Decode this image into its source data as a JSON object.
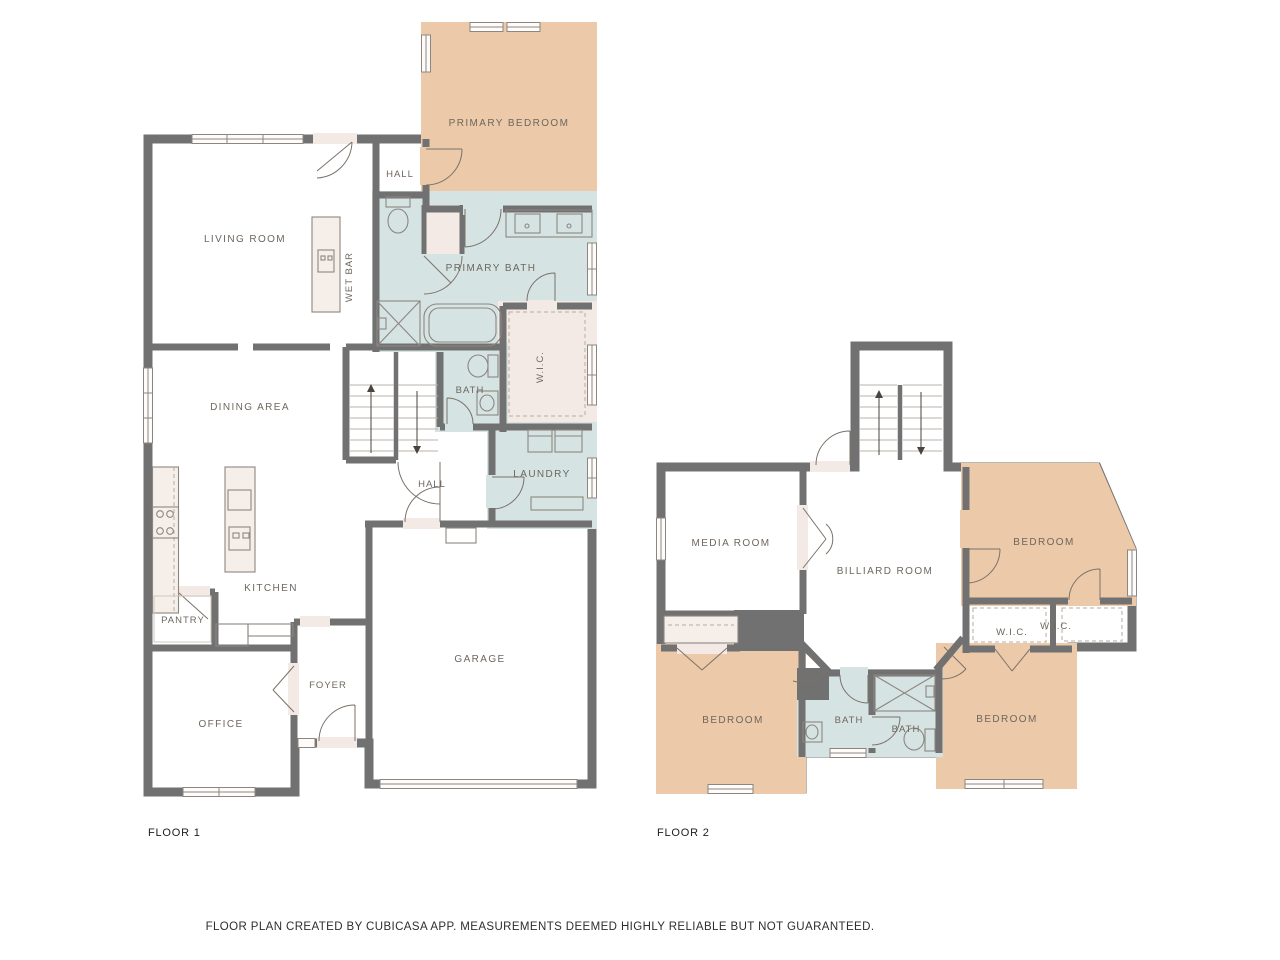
{
  "colors": {
    "background": "#ffffff",
    "wall": "#717171",
    "room_default": "#f3eae5",
    "room_bedroom": "#ebc9a9",
    "room_bath": "#d5e3e2",
    "label_text": "#6e675e",
    "footer_text": "#2e2e2e"
  },
  "floor1": {
    "label": "FLOOR 1",
    "rooms": {
      "living": "LIVING ROOM",
      "wet_bar": "WET BAR",
      "hall_upper": "HALL",
      "primary_bedroom": "PRIMARY BEDROOM",
      "primary_bath": "PRIMARY BATH",
      "wic": "W.I.C.",
      "bath": "BATH",
      "dining": "DINING AREA",
      "laundry": "LAUNDRY",
      "hall": "HALL",
      "kitchen": "KITCHEN",
      "pantry": "PANTRY",
      "foyer": "FOYER",
      "office": "OFFICE",
      "garage": "GARAGE"
    }
  },
  "floor2": {
    "label": "FLOOR 2",
    "rooms": {
      "media": "MEDIA ROOM",
      "billiard": "BILLIARD ROOM",
      "bedroom_ne": "BEDROOM",
      "wic_left": "W.I.C.",
      "wic_right": "W.I.C.",
      "bedroom_sw": "BEDROOM",
      "bath_left": "BATH",
      "bath_right": "BATH",
      "bedroom_se": "BEDROOM"
    }
  },
  "footer": {
    "disclaimer": "FLOOR PLAN CREATED BY CUBICASA APP. MEASUREMENTS DEEMED HIGHLY RELIABLE BUT NOT GUARANTEED."
  }
}
